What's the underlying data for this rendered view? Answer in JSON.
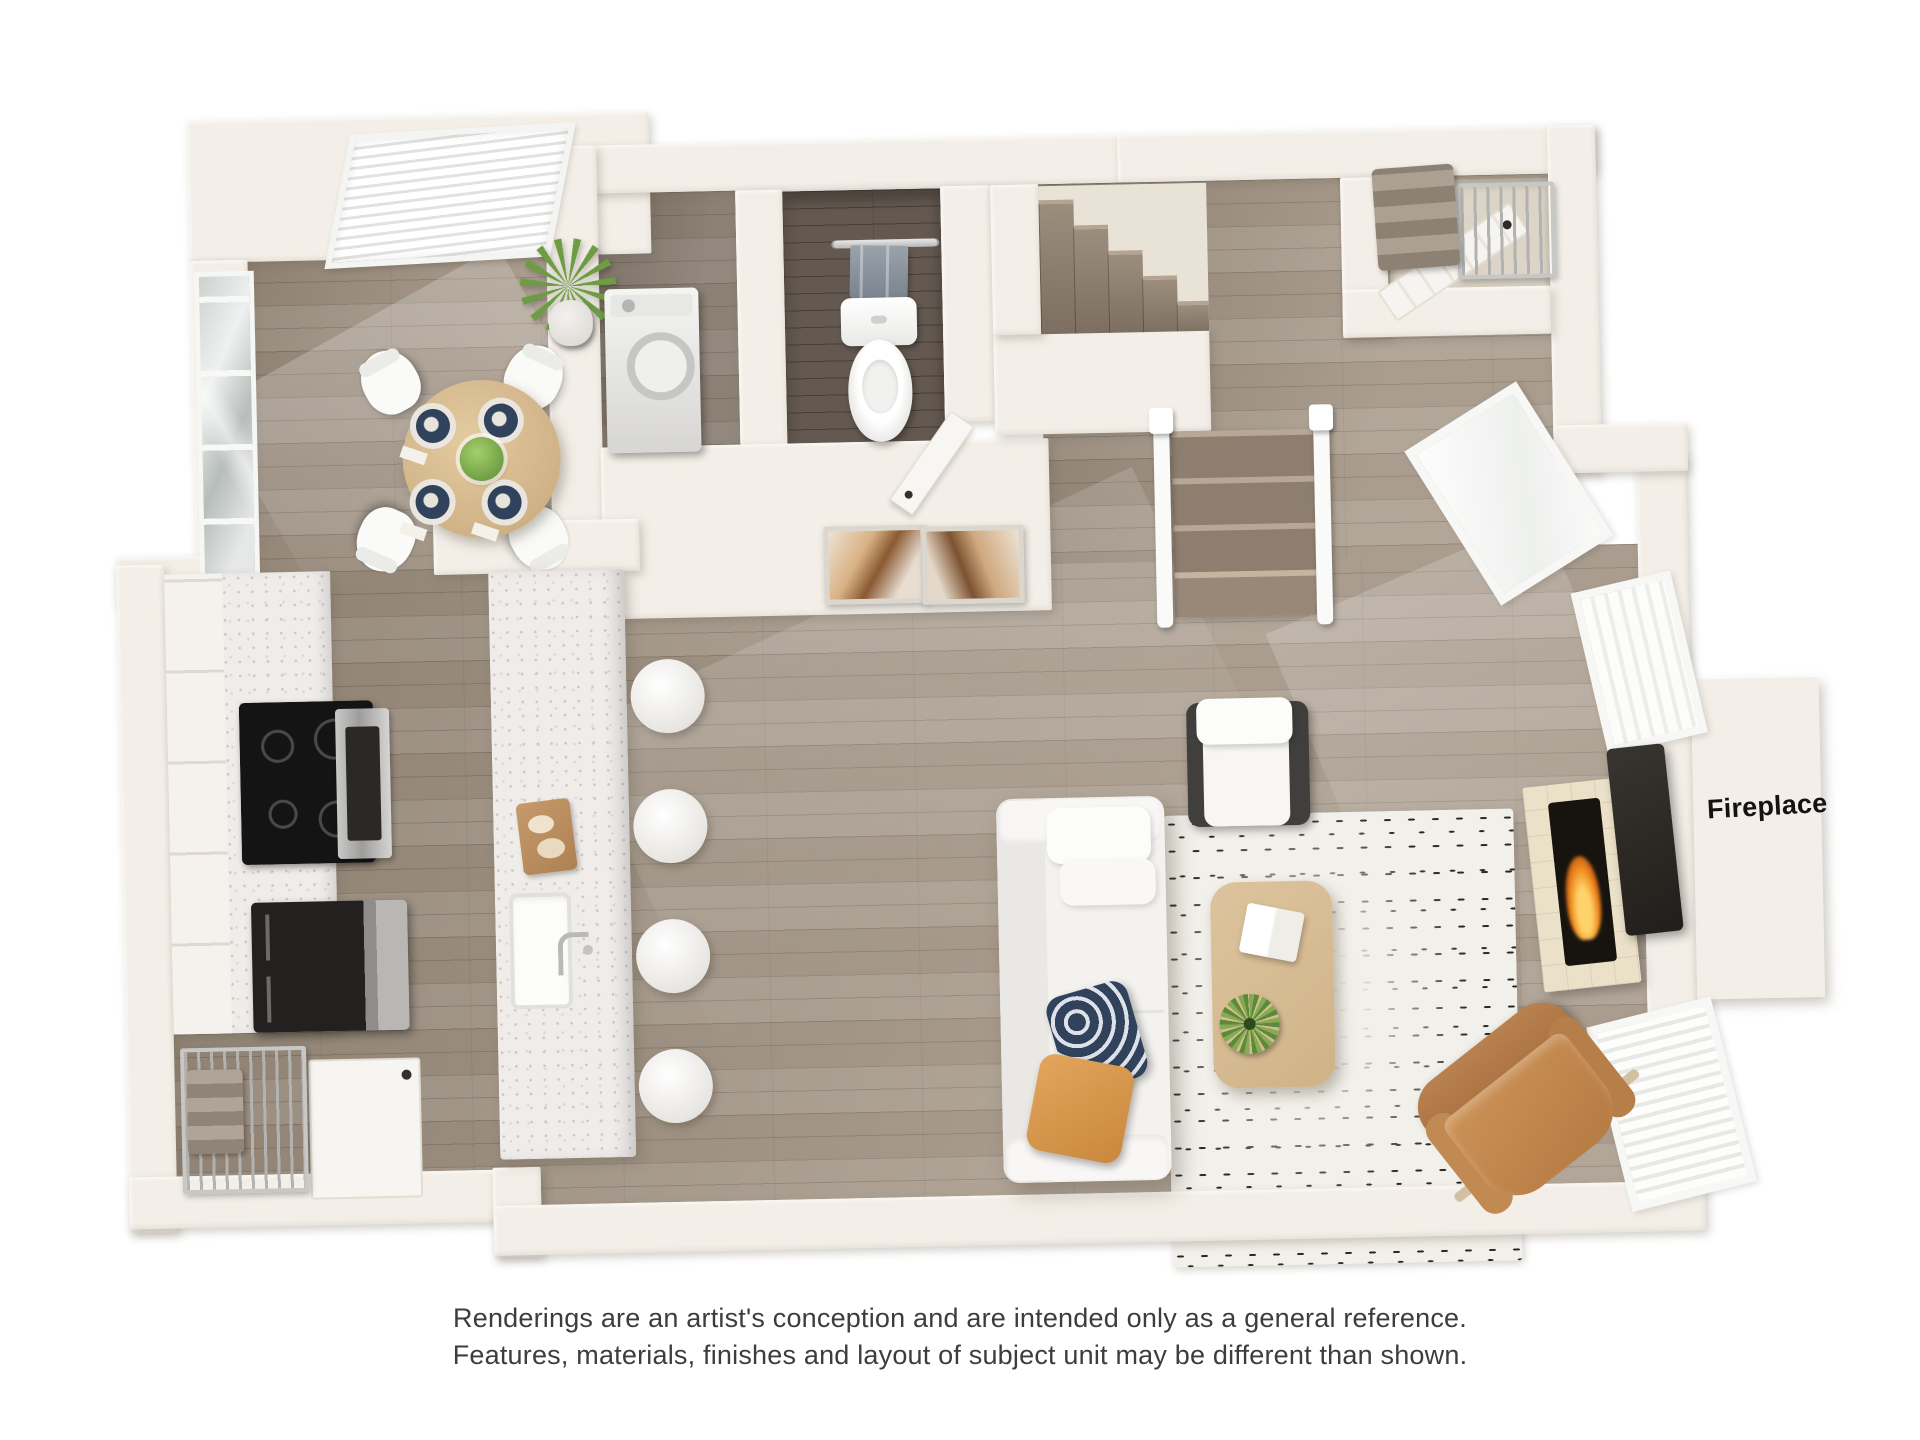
{
  "page": {
    "background": "#ffffff"
  },
  "floorplan": {
    "fireplace_label": "Fireplace",
    "rooms": [
      "dining-area",
      "kitchen",
      "laundry-closet",
      "powder-bathroom",
      "staircase",
      "entry-hall",
      "entry-closet",
      "storage-closet",
      "living-room"
    ],
    "furniture": [
      "bay-window-blinds",
      "sliding-glass-door",
      "house-plant",
      "round-dining-table",
      "dining-chairs",
      "place-settings",
      "fruit-bowl",
      "range-cooktop",
      "oven",
      "refrigerator",
      "kitchen-island",
      "island-sink",
      "faucet",
      "cutting-board",
      "bar-stools",
      "wire-shelving",
      "closet-door",
      "washer",
      "towel-bar",
      "hand-towel",
      "toilet",
      "wall-art-frames",
      "upper-stair-flight",
      "lower-stair-flight",
      "stair-railings",
      "entry-door",
      "linen-shelf",
      "folded-towels",
      "sectional-sofa",
      "headrest-pillows",
      "navy-throw-pillow",
      "orange-throw-pillow",
      "area-rug",
      "coffee-table",
      "book",
      "potted-plant",
      "lounge-chair",
      "leather-armchair",
      "fireplace-surround",
      "firebox-flame",
      "wall-mounted-panel",
      "windows",
      "floor-threshold"
    ],
    "colors": {
      "page_bg": "#ffffff",
      "wall": "#f3eee7",
      "floor": "#a39585",
      "floor_dark": "#645950",
      "stair_wood": "#8d7e6f",
      "rug": "#f2f0ea",
      "rug_pattern": "#2b2823",
      "appliance_dark": "#23211f",
      "table_wood": "#d0b287",
      "leather": "#b57a42",
      "pillow_navy": "#31435c",
      "pillow_orange": "#c9873c",
      "plant_green": "#6d9c43",
      "plate_navy": "#31435c",
      "flame": "#f08c1e"
    }
  },
  "disclaimer": {
    "line1": "Renderings are an artist's conception and are intended only as a general reference.",
    "line2": "Features, materials, finishes and layout of subject unit may be different than shown."
  }
}
